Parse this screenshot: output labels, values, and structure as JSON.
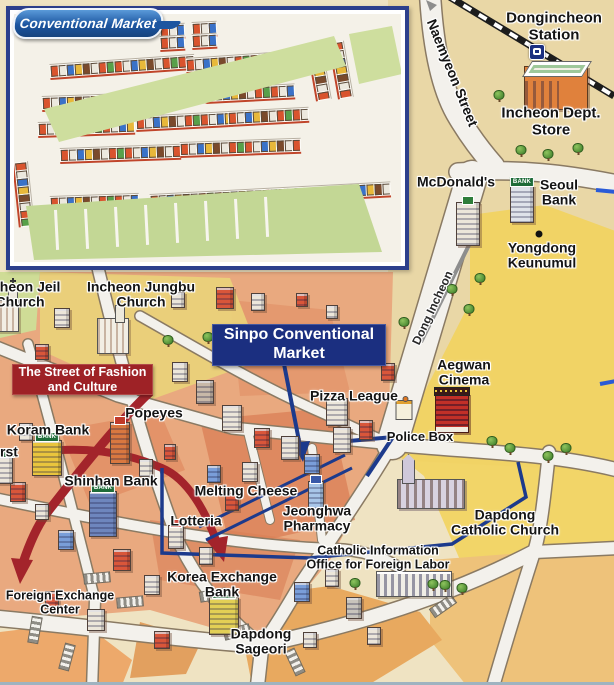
{
  "colors": {
    "navy": "#1c3a8c",
    "banner_navy": "#1b2f80",
    "banner_red": "#9e2226",
    "road": "#f3f1ec",
    "road_edge": "#8a7a63",
    "terrain_tan": "#e9d7a6",
    "terrain_yellow": "#f2d35e",
    "terrain_orange": "#eec27a",
    "urban": "#e9a97f",
    "green": "#cede9e",
    "railway": "#1c1c1c",
    "arrow_gray": "#8d8d8d",
    "route_red": "#a3242b",
    "blue_dash": "#2a5bd7"
  },
  "bank_sign": "BANK",
  "banners": {
    "sinpo": "Sinpo Conventional\nMarket",
    "fashion_street": "The Street of Fashion\nand Culture"
  },
  "inset": {
    "logo": "Conventional Market",
    "pharmacy_label": "Jeonghwa\nPharmacy",
    "stall_palette": [
      "#d9542e",
      "#ece8de",
      "#3a72c8",
      "#e8b83a",
      "#7a4a2c",
      "#ece8de",
      "#d9542e",
      "#58a04a"
    ],
    "stall_rows": [
      {
        "x": 36,
        "y": 50,
        "n": 18,
        "rot": -4
      },
      {
        "x": 172,
        "y": 44,
        "n": 17,
        "rot": -4
      },
      {
        "x": 28,
        "y": 82,
        "n": 10,
        "rot": -2
      },
      {
        "x": 104,
        "y": 78,
        "n": 11,
        "rot": -3
      },
      {
        "x": 192,
        "y": 74,
        "n": 11,
        "rot": -3
      },
      {
        "x": 24,
        "y": 108,
        "n": 12,
        "rot": -2
      },
      {
        "x": 122,
        "y": 102,
        "n": 12,
        "rot": -3
      },
      {
        "x": 214,
        "y": 97,
        "n": 10,
        "rot": -3
      },
      {
        "x": 46,
        "y": 134,
        "n": 15,
        "rot": -2
      },
      {
        "x": 166,
        "y": 128,
        "n": 15,
        "rot": -2
      },
      {
        "x": 36,
        "y": 182,
        "n": 11,
        "rot": -2
      },
      {
        "x": 136,
        "y": 180,
        "n": 30,
        "rot": -3
      },
      {
        "x": 300,
        "y": 22,
        "n": 7,
        "rot": 80
      },
      {
        "x": 322,
        "y": 20,
        "n": 7,
        "rot": 80
      },
      {
        "x": 6,
        "y": 140,
        "n": 8,
        "rot": 84
      },
      {
        "x": 146,
        "y": 10,
        "n": 3,
        "rot": -3
      },
      {
        "x": 146,
        "y": 22,
        "n": 3,
        "rot": -3
      },
      {
        "x": 178,
        "y": 8,
        "n": 3,
        "rot": -3
      },
      {
        "x": 178,
        "y": 20,
        "n": 3,
        "rot": -3
      }
    ]
  },
  "labels": [
    {
      "id": "dongincheon-station-label",
      "text": "Dongincheon\nStation",
      "x": 554,
      "y": 27,
      "fs": 15
    },
    {
      "id": "incheon-dept-store-label",
      "text": "Incheon Dept.\nStore",
      "x": 551,
      "y": 122,
      "fs": 15
    },
    {
      "id": "naemyeon-street-label",
      "text": "Naemyeon Street",
      "x": 452,
      "y": 73,
      "fs": 14,
      "rot": 68
    },
    {
      "id": "mcdonalds-label",
      "text": "McDonald's",
      "x": 456,
      "y": 182,
      "fs": 14
    },
    {
      "id": "seoul-bank-label",
      "text": "Seoul\nBank",
      "x": 559,
      "y": 193,
      "fs": 14
    },
    {
      "id": "yongdong-keunumul-label",
      "text": "Yongdong\nKeunumul",
      "x": 542,
      "y": 256,
      "fs": 14
    },
    {
      "id": "dong-incheon-street-label",
      "text": "Dong Incheon",
      "x": 433,
      "y": 308,
      "fs": 12,
      "rot": -65,
      "wt": 600,
      "col": "#2a2a2a"
    },
    {
      "id": "incheon-jeil-church-label",
      "text": "Incheon Jeil\nChurch",
      "x": 20,
      "y": 295,
      "fs": 14
    },
    {
      "id": "incheon-jungbu-church-label",
      "text": "Incheon Jungbu\nChurch",
      "x": 141,
      "y": 295,
      "fs": 14
    },
    {
      "id": "aegwan-cinema-label",
      "text": "Aegwan\nCinema",
      "x": 464,
      "y": 373,
      "fs": 14
    },
    {
      "id": "pizza-league-label",
      "text": "Pizza League",
      "x": 354,
      "y": 396,
      "fs": 14
    },
    {
      "id": "police-box-label",
      "text": "Police Box",
      "x": 420,
      "y": 437,
      "fs": 13
    },
    {
      "id": "popeyes-label",
      "text": "Popeyes",
      "x": 154,
      "y": 413,
      "fs": 14
    },
    {
      "id": "koram-bank-label",
      "text": "Koram Bank",
      "x": 48,
      "y": 430,
      "fs": 14
    },
    {
      "id": "first-bank-label",
      "text": "rst",
      "x": 9,
      "y": 452,
      "fs": 14
    },
    {
      "id": "shinhan-bank-label",
      "text": "Shinhan Bank",
      "x": 111,
      "y": 481,
      "fs": 14
    },
    {
      "id": "melting-cheese-label",
      "text": "Melting Cheese",
      "x": 246,
      "y": 491,
      "fs": 14
    },
    {
      "id": "lotteria-label",
      "text": "Lotteria",
      "x": 196,
      "y": 521,
      "fs": 14
    },
    {
      "id": "jeonghwa-pharmacy-label",
      "text": "Jeonghwa\nPharmacy",
      "x": 317,
      "y": 519,
      "fs": 14
    },
    {
      "id": "catholic-office-label",
      "text": "Catholic Information\nOffice for Foreign Labor",
      "x": 378,
      "y": 558,
      "fs": 12.5
    },
    {
      "id": "dapdong-catholic-church-label",
      "text": "Dapdong\nCatholic Church",
      "x": 505,
      "y": 523,
      "fs": 14
    },
    {
      "id": "korea-exchange-bank-label",
      "text": "Korea Exchange\nBank",
      "x": 222,
      "y": 585,
      "fs": 14
    },
    {
      "id": "foreign-exchange-center-label",
      "text": "Foreign Exchange\nCenter",
      "x": 60,
      "y": 603,
      "fs": 12.5
    },
    {
      "id": "dapdong-sageori-label",
      "text": "Dapdong\nSageori",
      "x": 261,
      "y": 642,
      "fs": 14
    }
  ],
  "icons": [
    {
      "name": "crosswalk-marking",
      "type": "crosswalk",
      "x": 97,
      "y": 578,
      "rot": 85
    },
    {
      "name": "crosswalk-marking",
      "type": "crosswalk",
      "x": 130,
      "y": 602,
      "rot": 85
    },
    {
      "name": "crosswalk-marking",
      "type": "crosswalk",
      "x": 213,
      "y": 595,
      "rot": 80
    },
    {
      "name": "crosswalk-marking",
      "type": "crosswalk",
      "x": 237,
      "y": 632,
      "rot": 75
    },
    {
      "name": "crosswalk-marking",
      "type": "crosswalk",
      "x": 295,
      "y": 662,
      "rot": -25
    },
    {
      "name": "crosswalk-marking",
      "type": "crosswalk",
      "x": 443,
      "y": 606,
      "rot": 55
    },
    {
      "name": "crosswalk-marking",
      "type": "crosswalk",
      "x": 35,
      "y": 630,
      "rot": 10
    },
    {
      "name": "crosswalk-marking",
      "type": "crosswalk",
      "x": 67,
      "y": 657,
      "rot": 15
    },
    {
      "name": "city-block-building",
      "type": "block",
      "x": 225,
      "y": 298,
      "w": 18,
      "h": 22,
      "c": "#d9563a"
    },
    {
      "name": "city-block-building",
      "type": "block",
      "x": 258,
      "y": 302,
      "w": 14,
      "h": 18,
      "c": "#ece6da"
    },
    {
      "name": "city-block-building",
      "type": "block",
      "x": 180,
      "y": 372,
      "w": 16,
      "h": 20,
      "c": "#ece6da"
    },
    {
      "name": "city-block-building",
      "type": "block",
      "x": 205,
      "y": 392,
      "w": 18,
      "h": 24,
      "c": "#c8b8a8"
    },
    {
      "name": "city-block-building",
      "type": "block",
      "x": 62,
      "y": 318,
      "w": 16,
      "h": 20,
      "c": "#ece6da"
    },
    {
      "name": "city-block-building",
      "type": "block",
      "x": 42,
      "y": 352,
      "w": 14,
      "h": 16,
      "c": "#d9563a"
    },
    {
      "name": "city-block-building",
      "type": "block",
      "x": 232,
      "y": 418,
      "w": 20,
      "h": 26,
      "c": "#ece6da"
    },
    {
      "name": "city-block-building",
      "type": "block",
      "x": 262,
      "y": 438,
      "w": 16,
      "h": 20,
      "c": "#d9563a"
    },
    {
      "name": "city-block-building",
      "type": "block",
      "x": 290,
      "y": 448,
      "w": 18,
      "h": 24,
      "c": "#ece6da"
    },
    {
      "name": "city-block-building",
      "type": "block",
      "x": 312,
      "y": 464,
      "w": 16,
      "h": 20,
      "c": "#7a9ed9"
    },
    {
      "name": "city-block-building",
      "type": "block",
      "x": 342,
      "y": 440,
      "w": 18,
      "h": 26,
      "c": "#ece6da"
    },
    {
      "name": "city-block-building",
      "type": "block",
      "x": 366,
      "y": 430,
      "w": 14,
      "h": 20,
      "c": "#d9563a"
    },
    {
      "name": "city-block-building",
      "type": "block",
      "x": 250,
      "y": 472,
      "w": 16,
      "h": 20,
      "c": "#ece6da"
    },
    {
      "name": "city-block-building",
      "type": "block",
      "x": 214,
      "y": 474,
      "w": 14,
      "h": 18,
      "c": "#7a9ed9"
    },
    {
      "name": "city-block-building",
      "type": "block",
      "x": 146,
      "y": 468,
      "w": 14,
      "h": 18,
      "c": "#ece6da"
    },
    {
      "name": "city-block-building",
      "type": "block",
      "x": 170,
      "y": 452,
      "w": 12,
      "h": 16,
      "c": "#d9563a"
    },
    {
      "name": "city-block-building",
      "type": "block",
      "x": 26,
      "y": 432,
      "w": 14,
      "h": 18,
      "c": "#ece6da"
    },
    {
      "name": "city-block-building",
      "type": "block",
      "x": 18,
      "y": 492,
      "w": 16,
      "h": 20,
      "c": "#d9563a"
    },
    {
      "name": "city-block-building",
      "type": "block",
      "x": 42,
      "y": 512,
      "w": 14,
      "h": 16,
      "c": "#ece6da"
    },
    {
      "name": "city-block-building",
      "type": "block",
      "x": 66,
      "y": 540,
      "w": 16,
      "h": 20,
      "c": "#7a9ed9"
    },
    {
      "name": "city-block-building",
      "type": "block",
      "x": 122,
      "y": 560,
      "w": 18,
      "h": 22,
      "c": "#d9563a"
    },
    {
      "name": "city-block-building",
      "type": "block",
      "x": 152,
      "y": 585,
      "w": 16,
      "h": 20,
      "c": "#ece6da"
    },
    {
      "name": "city-block-building",
      "type": "block",
      "x": 96,
      "y": 620,
      "w": 18,
      "h": 22,
      "c": "#ece6da"
    },
    {
      "name": "city-block-building",
      "type": "block",
      "x": 52,
      "y": 600,
      "w": 14,
      "h": 18,
      "c": "#d9563a"
    },
    {
      "name": "city-block-building",
      "type": "block",
      "x": 206,
      "y": 556,
      "w": 14,
      "h": 18,
      "c": "#ece6da"
    },
    {
      "name": "city-block-building",
      "type": "block",
      "x": 232,
      "y": 502,
      "w": 14,
      "h": 18,
      "c": "#d9563a"
    },
    {
      "name": "city-block-building",
      "type": "block",
      "x": 302,
      "y": 592,
      "w": 16,
      "h": 20,
      "c": "#7a9ed9"
    },
    {
      "name": "city-block-building",
      "type": "block",
      "x": 332,
      "y": 578,
      "w": 14,
      "h": 18,
      "c": "#ece6da"
    },
    {
      "name": "city-block-building",
      "type": "block",
      "x": 354,
      "y": 608,
      "w": 16,
      "h": 22,
      "c": "#c8c4bc"
    },
    {
      "name": "city-block-building",
      "type": "block",
      "x": 374,
      "y": 636,
      "w": 14,
      "h": 18,
      "c": "#ece6da"
    },
    {
      "name": "city-block-building",
      "type": "block",
      "x": 178,
      "y": 300,
      "w": 14,
      "h": 16,
      "c": "#ece6da"
    },
    {
      "name": "city-block-building",
      "type": "block",
      "x": 302,
      "y": 300,
      "w": 12,
      "h": 14,
      "c": "#d9563a"
    },
    {
      "name": "city-block-building",
      "type": "block",
      "x": 332,
      "y": 312,
      "w": 12,
      "h": 14,
      "c": "#ece6da"
    },
    {
      "name": "city-block-building",
      "type": "block",
      "x": 372,
      "y": 332,
      "w": 14,
      "h": 16,
      "c": "#ece6da"
    },
    {
      "name": "city-block-building",
      "type": "block",
      "x": 388,
      "y": 372,
      "w": 14,
      "h": 18,
      "c": "#d9563a"
    },
    {
      "name": "city-block-building",
      "type": "block",
      "x": 162,
      "y": 640,
      "w": 16,
      "h": 18,
      "c": "#d9563a"
    },
    {
      "name": "city-block-building",
      "type": "block",
      "x": 310,
      "y": 640,
      "w": 14,
      "h": 16,
      "c": "#ece6da"
    },
    {
      "name": "train-icon",
      "type": "train",
      "x": 537,
      "y": 52,
      "w": 16,
      "h": 16
    },
    {
      "name": "incheon-dept-store-building",
      "type": "dept",
      "x": 556,
      "y": 88,
      "w": 64,
      "h": 44
    },
    {
      "name": "mcdonalds-building",
      "type": "tower",
      "x": 468,
      "y": 224,
      "w": 24,
      "h": 44,
      "c": "#ece6da",
      "sign": "#2e7d3a"
    },
    {
      "name": "seoul-bank-building",
      "type": "bank",
      "x": 522,
      "y": 204,
      "w": 24,
      "h": 38,
      "c": "#dfe3ea"
    },
    {
      "name": "yongdong-keunumul-dot",
      "type": "dot",
      "x": 539,
      "y": 234,
      "w": 7,
      "h": 7
    },
    {
      "name": "aegwan-cinema-building",
      "type": "cinema",
      "x": 452,
      "y": 413,
      "w": 34,
      "h": 40
    },
    {
      "name": "police-box-building",
      "type": "police",
      "x": 404,
      "y": 410,
      "w": 17,
      "h": 20
    },
    {
      "name": "dapdong-catholic-church-building",
      "type": "bigchurch",
      "x": 431,
      "y": 494,
      "w": 68,
      "h": 30
    },
    {
      "name": "catholic-office-building",
      "type": "office",
      "x": 414,
      "y": 584,
      "w": 76,
      "h": 26
    },
    {
      "name": "incheon-jungbu-church-building",
      "type": "church",
      "x": 113,
      "y": 336,
      "w": 32,
      "h": 36
    },
    {
      "name": "incheon-jeil-church-building",
      "type": "church",
      "x": 6,
      "y": 316,
      "w": 26,
      "h": 32
    },
    {
      "name": "koram-bank-building",
      "type": "bank",
      "x": 47,
      "y": 458,
      "w": 30,
      "h": 36,
      "c": "#e9c53d"
    },
    {
      "name": "bank-building-left",
      "type": "bank",
      "x": 3,
      "y": 470,
      "w": 20,
      "h": 28,
      "c": "#ece6da"
    },
    {
      "name": "shinhan-bank-building",
      "type": "bank",
      "x": 103,
      "y": 514,
      "w": 28,
      "h": 46,
      "c": "#6e86bd"
    },
    {
      "name": "korea-exchange-bank-building",
      "type": "bank",
      "x": 224,
      "y": 616,
      "w": 30,
      "h": 38,
      "c": "#e3cf55"
    },
    {
      "name": "popeyes-building",
      "type": "tower",
      "x": 120,
      "y": 443,
      "w": 20,
      "h": 42,
      "c": "#d97840",
      "sign": "#c03a2a"
    },
    {
      "name": "pizza-league-building",
      "type": "tower",
      "x": 337,
      "y": 412,
      "w": 22,
      "h": 28,
      "c": "#ece6da",
      "sign": "#2e8c46"
    },
    {
      "name": "lotteria-building",
      "type": "tower",
      "x": 176,
      "y": 537,
      "w": 16,
      "h": 24,
      "c": "#ece6da",
      "sign": "#cc3a30"
    },
    {
      "name": "jeonghwa-pharmacy-building",
      "type": "tower",
      "x": 316,
      "y": 495,
      "w": 16,
      "h": 28,
      "c": "#a8c6e8",
      "sign": "#3858a8"
    },
    {
      "name": "tree-icon",
      "type": "tree",
      "x": 499,
      "y": 95
    },
    {
      "name": "tree-icon",
      "type": "tree",
      "x": 578,
      "y": 148
    },
    {
      "name": "tree-icon",
      "type": "tree",
      "x": 548,
      "y": 154
    },
    {
      "name": "tree-icon",
      "type": "tree",
      "x": 521,
      "y": 150
    },
    {
      "name": "tree-icon",
      "type": "tree",
      "x": 404,
      "y": 322
    },
    {
      "name": "tree-icon",
      "type": "tree",
      "x": 452,
      "y": 289
    },
    {
      "name": "tree-icon",
      "type": "tree",
      "x": 469,
      "y": 309
    },
    {
      "name": "tree-icon",
      "type": "tree",
      "x": 480,
      "y": 278
    },
    {
      "name": "tree-icon",
      "type": "tree",
      "x": 492,
      "y": 441
    },
    {
      "name": "tree-icon",
      "type": "tree",
      "x": 510,
      "y": 448
    },
    {
      "name": "tree-icon",
      "type": "tree",
      "x": 548,
      "y": 456
    },
    {
      "name": "tree-icon",
      "type": "tree",
      "x": 566,
      "y": 448
    },
    {
      "name": "tree-icon",
      "type": "tree",
      "x": 355,
      "y": 583
    },
    {
      "name": "tree-icon",
      "type": "tree",
      "x": 445,
      "y": 585
    },
    {
      "name": "tree-icon",
      "type": "tree",
      "x": 462,
      "y": 588
    },
    {
      "name": "tree-icon",
      "type": "tree",
      "x": 433,
      "y": 584
    },
    {
      "name": "tree-icon",
      "type": "tree",
      "x": 168,
      "y": 340
    },
    {
      "name": "tree-icon",
      "type": "tree",
      "x": 208,
      "y": 337
    }
  ]
}
